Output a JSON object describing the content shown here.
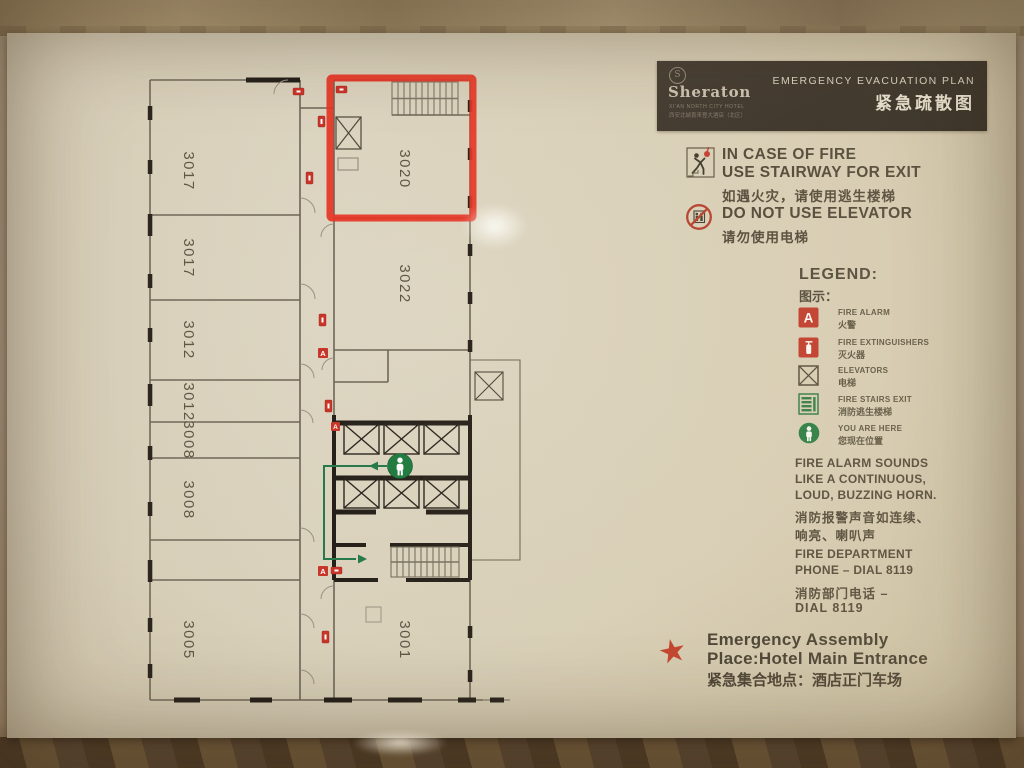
{
  "header": {
    "brand": "Sheraton",
    "logo_glyph": "S",
    "sub_en": "XI'AN NORTH CITY HOTEL",
    "sub_zh": "西安北城喜来登大酒店（北区）",
    "title_en": "EMERGENCY EVACUATION PLAN",
    "title_zh": "紧急疏散图"
  },
  "instructions": {
    "fire_en1": "IN CASE OF FIRE",
    "fire_en2": "USE STAIRWAY FOR EXIT",
    "fire_zh": "如遇火灾，请使用逃生楼梯",
    "elevator_en": "DO NOT USE ELEVATOR",
    "elevator_zh": "请勿使用电梯"
  },
  "legend": {
    "title_en": "LEGEND:",
    "title_zh": "图示：",
    "items": [
      {
        "glyph": "A",
        "en": "FIRE ALARM",
        "zh": "火警"
      },
      {
        "en": "FIRE EXTINGUISHERS",
        "zh": "灭火器"
      },
      {
        "en": "ELEVATORS",
        "zh": "电梯"
      },
      {
        "en": "FIRE STAIRS EXIT",
        "zh": "消防逃生楼梯"
      },
      {
        "en": "YOU ARE HERE",
        "zh": "您现在位置"
      }
    ]
  },
  "notes": {
    "alarm_en": [
      "FIRE ALARM SOUNDS",
      "LIKE A CONTINUOUS,",
      "LOUD, BUZZING HORN."
    ],
    "alarm_zh": [
      "消防报警声音如连续、",
      "响亮、喇叭声"
    ],
    "phone_en": [
      "FIRE DEPARTMENT",
      "PHONE – DIAL 8119"
    ],
    "phone_zh": [
      "消防部门电话 –",
      "DIAL 8119"
    ]
  },
  "assembly": {
    "star_glyph": "★",
    "en1": "Emergency Assembly",
    "en2": "Place:Hotel Main Entrance",
    "zh": "紧急集合地点：酒店正门车场"
  },
  "floorplan": {
    "highlighted_room": "3020",
    "rooms": [
      {
        "label": "3017"
      },
      {
        "label": "3017"
      },
      {
        "label": "3012"
      },
      {
        "label": "3012"
      },
      {
        "label": "3008"
      },
      {
        "label": "3008"
      },
      {
        "label": "3005"
      },
      {
        "label": "3020"
      },
      {
        "label": "3022"
      },
      {
        "label": "3001"
      }
    ]
  },
  "colors": {
    "accent_red": "#c8352a",
    "highlight_red": "#e63324",
    "green": "#1e7a3f",
    "panel_dark": "#2a241f",
    "paper": "#d9d1bb"
  }
}
